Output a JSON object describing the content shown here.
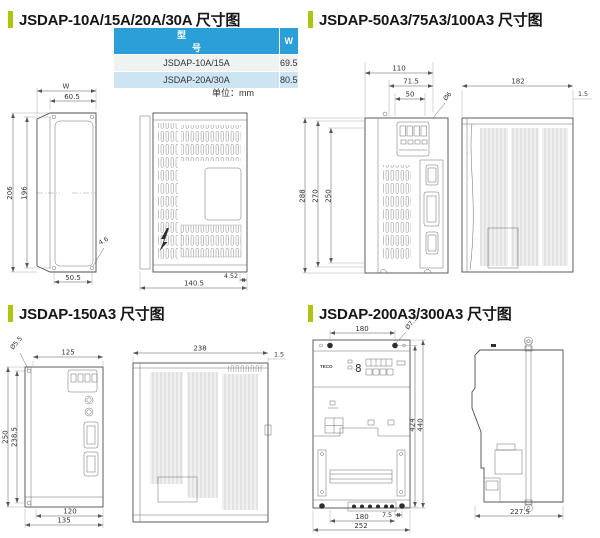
{
  "colors": {
    "accent_green": "#afc410",
    "table_header_blue": "#2b9fd7",
    "table_row_light": "#eef2f1",
    "table_row_blue": "#cde4f2",
    "drawing_line": "#555555"
  },
  "sections": {
    "s1": {
      "title": "JSDAP-10A/15A/20A/30A 尺寸图",
      "table": {
        "headers": [
          "型　　　　号",
          "W"
        ],
        "rows": [
          [
            "JSDAP-10A/15A",
            "69.5"
          ],
          [
            "JSDAP-20A/30A",
            "80.5"
          ]
        ],
        "unit": "单位：mm"
      },
      "dims": {
        "width_label": "W",
        "top_hole_span": "60.5",
        "overall_height": "206",
        "hole_pitch": "196",
        "hole_dia": "4.6",
        "bottom_hole_span": "50.5",
        "depth": "140.5",
        "foot_offset": "4.52"
      }
    },
    "s2": {
      "title": "JSDAP-50A3/75A3/100A3 尺寸图",
      "dims": {
        "overall_width": "110",
        "hole_span": "71.5",
        "keypad_span": "50",
        "hole_dia": "Ø6",
        "overall_height": "288",
        "body_height": "270",
        "hole_pitch": "250",
        "depth": "182",
        "panel_lip": "1.5"
      }
    },
    "s3": {
      "title": "JSDAP-150A3 尺寸图",
      "dims": {
        "hole_dia": "Ø5.5",
        "top_width": "125",
        "overall_height": "250",
        "hole_pitch": "238.5",
        "bottom_inner_width": "120",
        "bottom_width": "135",
        "depth": "238",
        "panel_lip": "1.5"
      }
    },
    "s4": {
      "title": "JSDAP-200A3/300A3 尺寸图",
      "brand": "TECO",
      "display_digit": "8",
      "dims": {
        "top_hole_span": "180",
        "hole_dia": "Ø7.5",
        "hole_pitch": "424",
        "overall_height": "440",
        "terminal_offset": "7.5",
        "bottom_hole_span": "180",
        "overall_width": "252",
        "depth": "227.5"
      }
    }
  }
}
